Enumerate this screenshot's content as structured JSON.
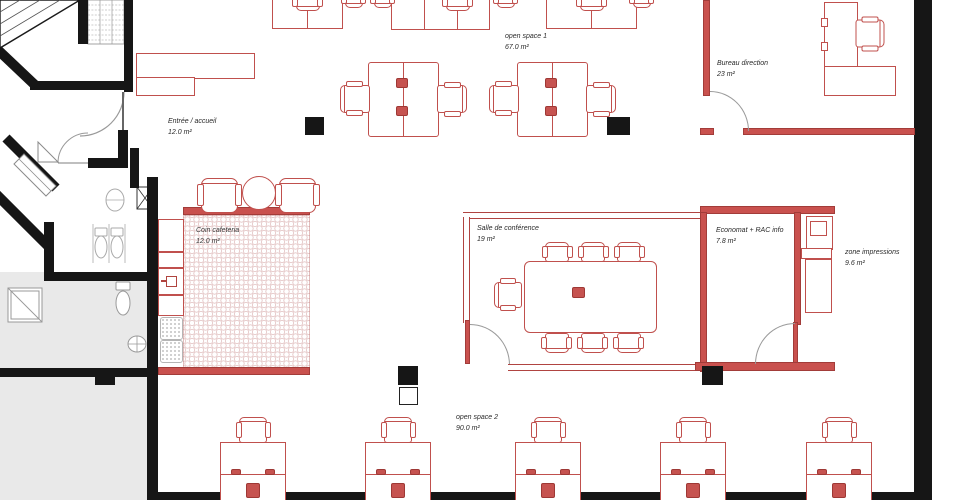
{
  "title": "Office floor plan",
  "rooms": [
    {
      "name": "open space 1",
      "area": "67.0 m²"
    },
    {
      "name": "Bureau direction",
      "area": "23 m²"
    },
    {
      "name": "Entrée / accueil",
      "area": "12.0 m²"
    },
    {
      "name": "Salle de conférence",
      "area": "19 m²"
    },
    {
      "name": "Economat + RAC info",
      "area": "7.8 m²"
    },
    {
      "name": "zone impressions",
      "area": "9.6 m²"
    },
    {
      "name": "Coin cafeteria",
      "area": "12.0 m²"
    },
    {
      "name": "open space 2",
      "area": "90.0 m²"
    }
  ],
  "colors": {
    "wall_black": "#161616",
    "wall_red": "#c9514e",
    "furniture_red": "#c0504d",
    "fixture_gray": "#a9a9a9",
    "floor_gray": "#e9e9e9"
  }
}
